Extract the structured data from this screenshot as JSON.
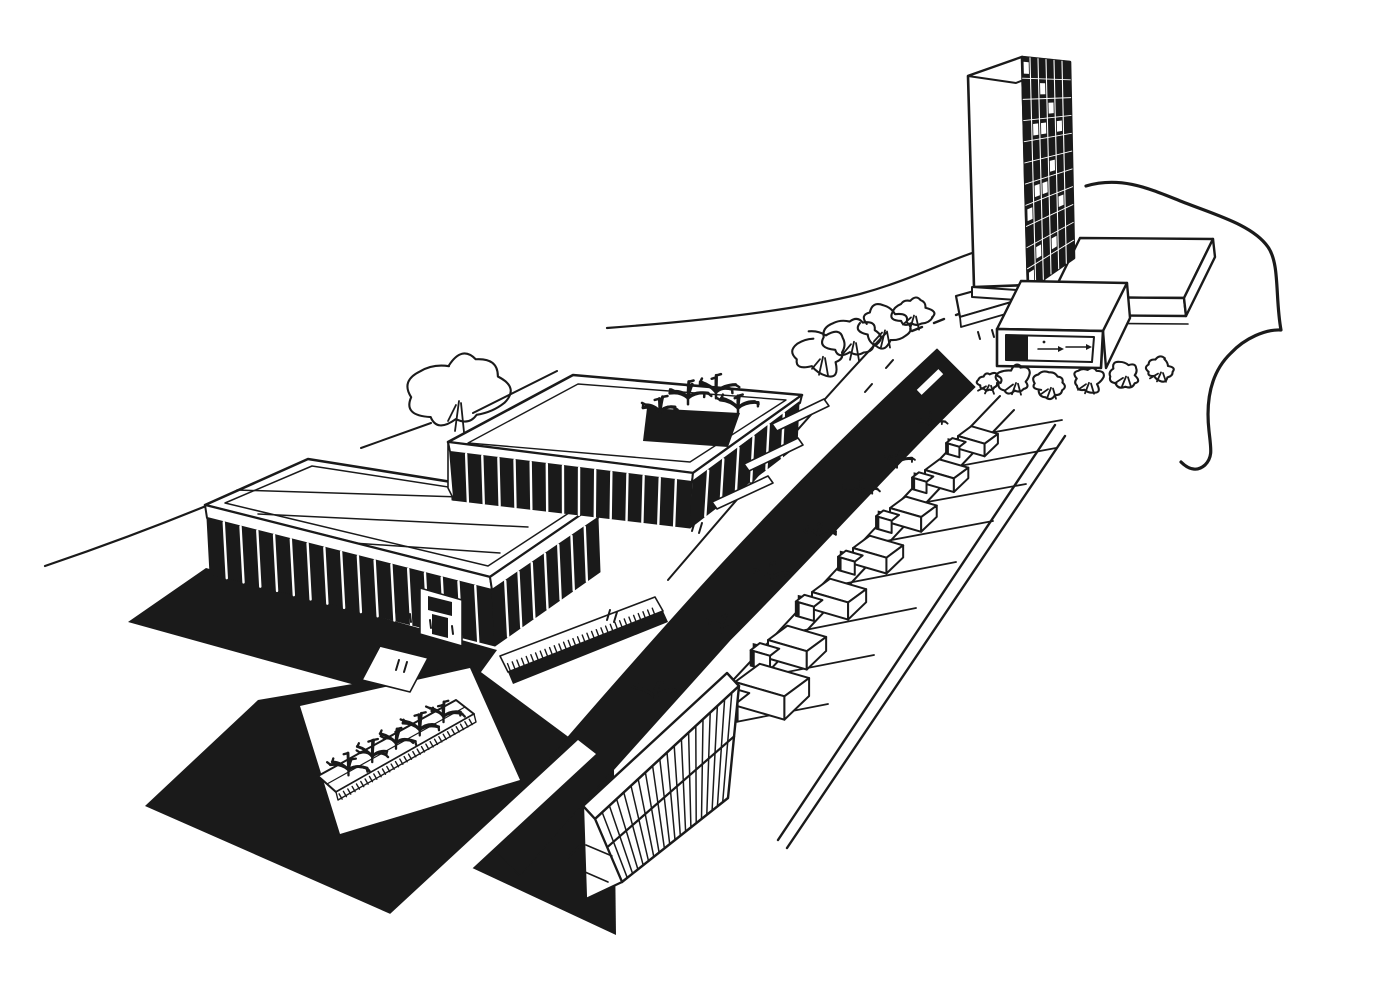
{
  "palette": {
    "ink": "#1a1a1a",
    "paper": "#ffffff"
  },
  "scene": {
    "type": "architectural-perspective-ink-sketch",
    "elements": [
      "office-tower-slab",
      "podium-slab",
      "entrance-box-building",
      "assembly-hall-pavilion",
      "courtyard-pavilion",
      "boulevard-road",
      "row-houses",
      "housing-lots",
      "apartment-slab-building",
      "planter-strip",
      "plaza-walkways",
      "cast-shadows",
      "trees",
      "shrubs",
      "site-boundary-line",
      "bench-strips"
    ],
    "counts": {
      "tower_bays": 6,
      "tower_floors": 11,
      "hall_front_columns": 17,
      "hall_side_columns": 8,
      "pavilion_front_columns": 15,
      "pavilion_side_columns": 7,
      "row_houses": 7,
      "lot_plants": 7,
      "planter_plants": 5,
      "courtyard_plants": 4,
      "street_trees": 4,
      "shrubs": 6,
      "slab_louvers": 20
    }
  }
}
